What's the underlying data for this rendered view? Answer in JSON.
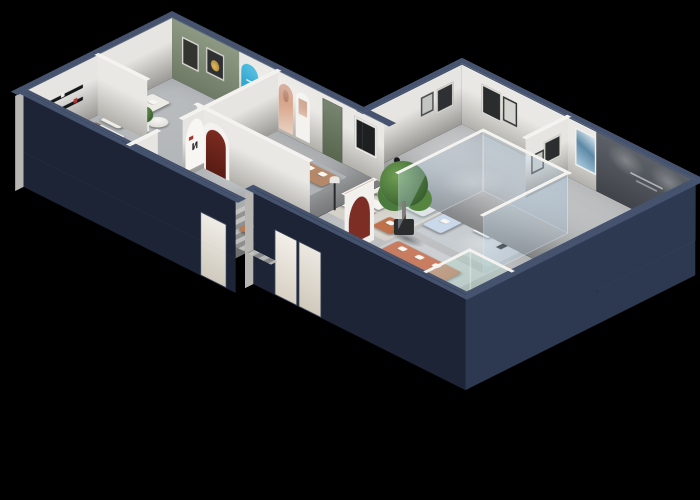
{
  "scene": {
    "type": "isometric-3d-floorplan-render",
    "subject": "Furniture showroom dollhouse cutaway on black background",
    "background_color": "#000000",
    "arch_poster_glyph": "N",
    "accent_wall_caption_legible": false,
    "palette": {
      "exterior_wall_navy": "#1d2435",
      "exterior_wall_navy_side": "#2c3950",
      "wall_top_navy": "#46536e",
      "interior_wall": "#e9e7e3",
      "accent_wall_green": "#86927d",
      "accent_wall_dark": "#585d63",
      "arch_blue": "#2da8d2",
      "arch_dark_red": "#6e241c",
      "partition_maroon": "#7c2d24",
      "floor_gray": "#bfc1c3",
      "rug_beige": "#d6d1c6",
      "sofa_white": "#efede7",
      "sofa_orange": "#f4a51c",
      "sofa_sage": "#a9bcaa",
      "sofa_salmon": "#c87d61",
      "sofa_tan": "#b6886a",
      "sofa_light_blue": "#c9d9ea",
      "ottoman_copper": "#b35f41",
      "ottoman_teal": "#4e86a0",
      "plant_green": "#4a7a3c",
      "table_black": "#17181a"
    },
    "wings": [
      {
        "name": "left-wing",
        "rooms": [
          {
            "name": "arch-display-lounge",
            "features": [
              "sage green accent wall with two framed artworks",
              "blue arched display panel",
              "three white arched display panels",
              "white sofa with orange pillows",
              "round side table",
              "desk and chair"
            ]
          },
          {
            "name": "tan-sofa-room",
            "features": [
              "tan loveseat",
              "copper ottoman",
              "round coffee table",
              "green door",
              "dark red arched niche"
            ]
          },
          {
            "name": "bedroom-media-room",
            "features": [
              "bed with orange throw",
              "black wall shelves",
              "long black media console",
              "white appliance",
              "round black table"
            ]
          },
          {
            "name": "corridor",
            "features": [
              "striped runner rug",
              "terracotta armchair",
              "white arch poster with letter N"
            ]
          }
        ]
      },
      {
        "name": "right-wing",
        "rooms": [
          {
            "name": "sage-lounge",
            "features": [
              "sage green sofa with chaise",
              "black oval coffee table",
              "sage armchair",
              "framed artwork",
              "blue abstract painting"
            ]
          },
          {
            "name": "orange-lounge",
            "features": [
              "dark accent wall with small light caption",
              "orange L-shaped sectional with white pillows",
              "beige area rug",
              "two round white side tables",
              "black media console",
              "white armchair",
              "teddy bear plush",
              "maroon accent chair"
            ]
          },
          {
            "name": "glass-room",
            "features": [
              "glass partition walls with white top rails",
              "light blue sectional sofa",
              "white coffee table"
            ]
          },
          {
            "name": "center-hall",
            "features": [
              "white L-shaped sectional",
              "two white coffee tables",
              "terracotta armchair",
              "round black dining table with four chairs",
              "floor lamp",
              "black figure sculpture",
              "tall white partition with maroon arch",
              "large potted tree"
            ]
          },
          {
            "name": "salmon-lounge",
            "features": [
              "salmon sofa with white cushions",
              "black oval coffee table",
              "two white armchairs",
              "round side table"
            ]
          },
          {
            "name": "east-work-area",
            "features": [
              "white cabinet row",
              "white desk",
              "two white chairs",
              "beige chaise",
              "teal ottoman",
              "black side table"
            ]
          },
          {
            "name": "front-display",
            "features": [
              "glass display case",
              "cactus plants",
              "gray console sideboard",
              "entry door panels"
            ]
          }
        ]
      }
    ]
  }
}
